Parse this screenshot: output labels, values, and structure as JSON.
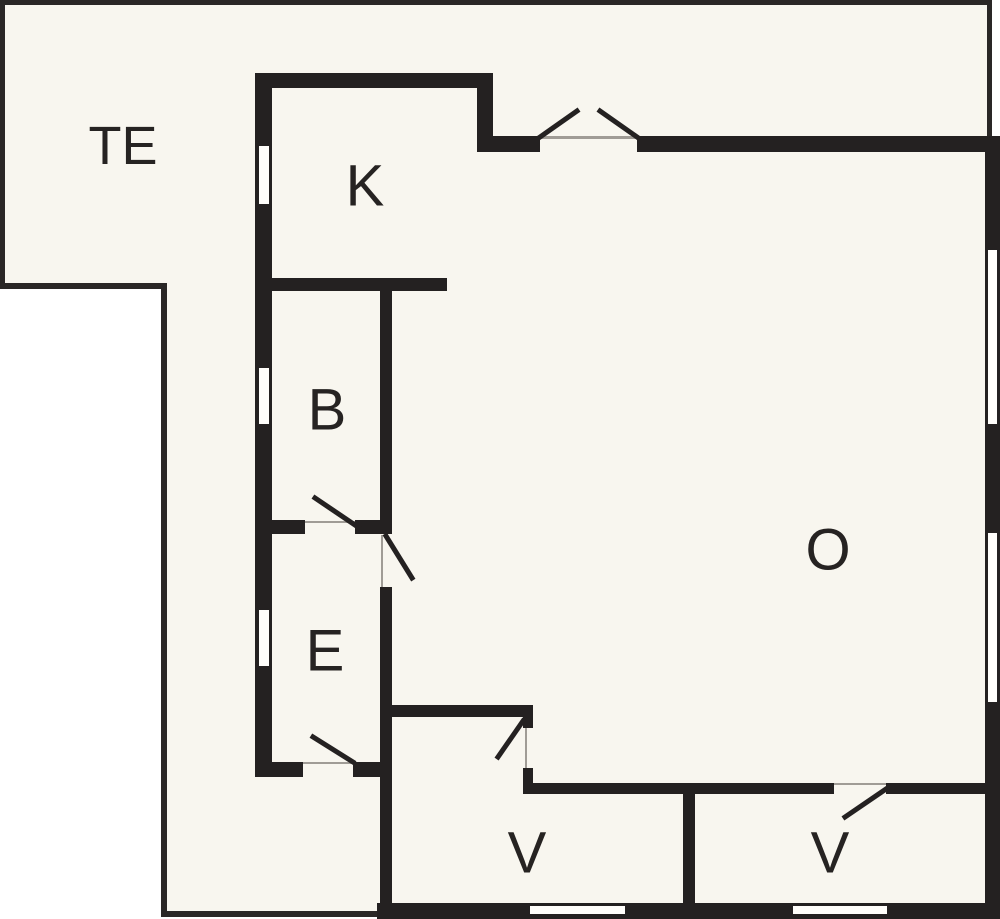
{
  "plan": {
    "canvas": {
      "width": 1000,
      "height": 919
    },
    "colors": {
      "page_background": "#ffffff",
      "plan_background": "#f8f6ef",
      "wall": "#242121",
      "outline": "#2a2726",
      "door_opening_line": "#a09c96",
      "window_fill": "#fffefb",
      "label": "#262322"
    },
    "interior_fill": {
      "points": "0,0 990,0 990,136 1000,136 1000,919 377,919 377,916 161,916 161,289 0,289"
    },
    "rooms": [
      {
        "id": "te",
        "label": "TE",
        "x": 123,
        "y": 146,
        "font_size": 54
      },
      {
        "id": "k",
        "label": "K",
        "x": 365,
        "y": 186,
        "font_size": 58
      },
      {
        "id": "b",
        "label": "B",
        "x": 327,
        "y": 410,
        "font_size": 58
      },
      {
        "id": "e",
        "label": "E",
        "x": 325,
        "y": 651,
        "font_size": 58
      },
      {
        "id": "o",
        "label": "O",
        "x": 828,
        "y": 550,
        "font_size": 58
      },
      {
        "id": "v1",
        "label": "V",
        "x": 527,
        "y": 853,
        "font_size": 58
      },
      {
        "id": "v2",
        "label": "V",
        "x": 830,
        "y": 853,
        "font_size": 58
      }
    ],
    "terrace_outline": [
      {
        "name": "terrace-outline-top",
        "x": 0,
        "y": 0,
        "w": 992,
        "h": 5
      },
      {
        "name": "terrace-outline-left",
        "x": 0,
        "y": 0,
        "w": 5,
        "h": 289
      },
      {
        "name": "terrace-outline-te-bottom",
        "x": 0,
        "y": 283,
        "w": 167,
        "h": 6
      },
      {
        "name": "terrace-outline-inner-vertical",
        "x": 161,
        "y": 283,
        "w": 6,
        "h": 634
      },
      {
        "name": "terrace-outline-bottom",
        "x": 161,
        "y": 911,
        "w": 222,
        "h": 6
      },
      {
        "name": "terrace-outline-right",
        "x": 987,
        "y": 0,
        "w": 5,
        "h": 140
      }
    ],
    "walls": [
      {
        "name": "kitchen-north-wall",
        "x": 255,
        "y": 73,
        "w": 238,
        "h": 15
      },
      {
        "name": "kitchen-east-step-wall",
        "x": 477,
        "y": 73,
        "w": 16,
        "h": 79
      },
      {
        "name": "north-step-wall",
        "x": 477,
        "y": 136,
        "w": 63,
        "h": 16
      },
      {
        "name": "living-north-wall",
        "x": 637,
        "y": 136,
        "w": 348,
        "h": 16
      },
      {
        "name": "east-exterior-wall",
        "x": 985,
        "y": 136,
        "w": 15,
        "h": 783
      },
      {
        "name": "south-exterior-wall",
        "x": 377,
        "y": 903,
        "w": 623,
        "h": 16
      },
      {
        "name": "west-exterior-wall",
        "x": 255,
        "y": 73,
        "w": 17,
        "h": 704
      },
      {
        "name": "kitchen-bath-wall",
        "x": 255,
        "y": 278,
        "w": 192,
        "h": 13
      },
      {
        "name": "bath-east-wall",
        "x": 380,
        "y": 278,
        "w": 12,
        "h": 256
      },
      {
        "name": "bath-south-wall-west",
        "x": 255,
        "y": 520,
        "w": 50,
        "h": 14
      },
      {
        "name": "bath-south-wall-east",
        "x": 355,
        "y": 520,
        "w": 37,
        "h": 14
      },
      {
        "name": "entry-east-wall",
        "x": 380,
        "y": 587,
        "w": 12,
        "h": 316
      },
      {
        "name": "entry-south-wall-west",
        "x": 255,
        "y": 762,
        "w": 48,
        "h": 15
      },
      {
        "name": "entry-south-wall-east",
        "x": 353,
        "y": 762,
        "w": 39,
        "h": 15
      },
      {
        "name": "bedroom1-north-wall",
        "x": 380,
        "y": 705,
        "w": 152,
        "h": 12
      },
      {
        "name": "bedroom1-door-stub-north",
        "x": 523,
        "y": 705,
        "w": 10,
        "h": 23
      },
      {
        "name": "bedroom1-door-stub-south",
        "x": 523,
        "y": 768,
        "w": 10,
        "h": 26
      },
      {
        "name": "bedrooms-north-wall-west",
        "x": 523,
        "y": 783,
        "w": 311,
        "h": 11
      },
      {
        "name": "bedrooms-north-wall-east",
        "x": 886,
        "y": 783,
        "w": 99,
        "h": 11
      },
      {
        "name": "bedroom-divider-wall",
        "x": 683,
        "y": 783,
        "w": 12,
        "h": 120
      }
    ],
    "windows": [
      {
        "name": "kitchen-west-window",
        "x": 259,
        "y": 146,
        "w": 10,
        "h": 58
      },
      {
        "name": "bath-west-window",
        "x": 259,
        "y": 368,
        "w": 10,
        "h": 56
      },
      {
        "name": "entry-west-window",
        "x": 259,
        "y": 610,
        "w": 10,
        "h": 56
      },
      {
        "name": "living-east-window-1",
        "x": 988,
        "y": 250,
        "w": 9,
        "h": 174
      },
      {
        "name": "living-east-window-2",
        "x": 988,
        "y": 533,
        "w": 9,
        "h": 169
      },
      {
        "name": "bedroom1-south-window",
        "x": 530,
        "y": 906,
        "w": 95,
        "h": 8
      },
      {
        "name": "bedroom2-south-window",
        "x": 793,
        "y": 906,
        "w": 94,
        "h": 8
      }
    ],
    "door_opening_lines": [
      {
        "name": "patio-door-opening-line",
        "x": 540,
        "y": 136,
        "w": 97,
        "h": 3
      },
      {
        "name": "bath-door-opening-line",
        "x": 305,
        "y": 521,
        "w": 50,
        "h": 2
      },
      {
        "name": "entry-living-door-opening-line",
        "x": 381,
        "y": 535,
        "w": 2,
        "h": 52
      },
      {
        "name": "entry-door-opening-line",
        "x": 303,
        "y": 762,
        "w": 50,
        "h": 2
      },
      {
        "name": "bedroom1-door-opening-line",
        "x": 525,
        "y": 728,
        "w": 2,
        "h": 40
      },
      {
        "name": "bedroom2-door-opening-line",
        "x": 834,
        "y": 783,
        "w": 52,
        "h": 2
      }
    ],
    "door_leaves": [
      {
        "name": "patio-door-leaf-left",
        "x1": 540,
        "y1": 137,
        "x2": 577,
        "y2": 111
      },
      {
        "name": "patio-door-leaf-right",
        "x1": 637,
        "y1": 137,
        "x2": 600,
        "y2": 111
      },
      {
        "name": "bath-door-leaf",
        "x1": 358,
        "y1": 527,
        "x2": 315,
        "y2": 498
      },
      {
        "name": "entry-living-door-leaf",
        "x1": 386,
        "y1": 536,
        "x2": 412,
        "y2": 578
      },
      {
        "name": "entry-door-leaf",
        "x1": 353,
        "y1": 762,
        "x2": 313,
        "y2": 737
      },
      {
        "name": "bedroom1-door-leaf",
        "x1": 523,
        "y1": 721,
        "x2": 498,
        "y2": 757
      },
      {
        "name": "bedroom2-door-leaf",
        "x1": 886,
        "y1": 789,
        "x2": 845,
        "y2": 817
      }
    ]
  }
}
